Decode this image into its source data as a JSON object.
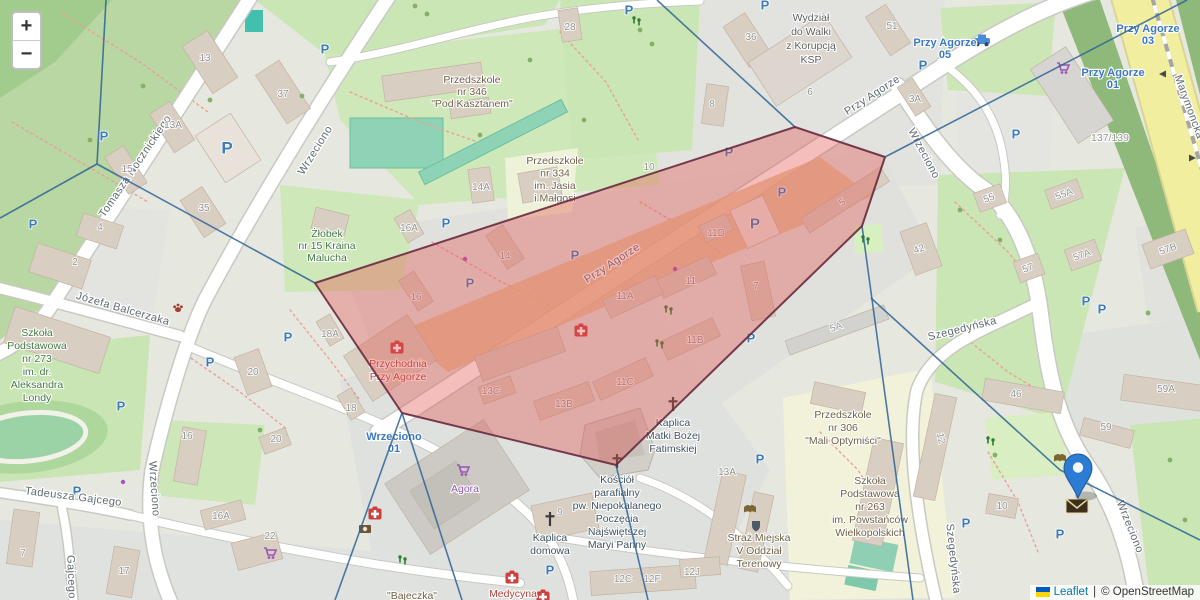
{
  "controls": {
    "zoom_in": "+",
    "zoom_out": "−"
  },
  "attribution": {
    "leaflet": "Leaflet",
    "separator": "|",
    "osm": "© OpenStreetMap"
  },
  "colors": {
    "polygon_fill": "#e35550",
    "polygon_border": "#68293f",
    "voronoi_line": "#2e6395",
    "marker_blue": "#2c7cd3",
    "transit_blue": "#3a78c2",
    "parking_blue": "#3d7ab8",
    "ukraine_flag_top": "#005BBB",
    "ukraine_flag_bottom": "#FFD500"
  },
  "overlay": {
    "polygon_points": [
      [
        315,
        283
      ],
      [
        795,
        127
      ],
      [
        885,
        157
      ],
      [
        862,
        226
      ],
      [
        616,
        465
      ],
      [
        402,
        413
      ]
    ],
    "lines": [
      [
        [
          106,
          0
        ],
        [
          97,
          164
        ]
      ],
      [
        [
          97,
          164
        ],
        [
          0,
          218
        ]
      ],
      [
        [
          97,
          164
        ],
        [
          315,
          283
        ]
      ],
      [
        [
          657,
          0
        ],
        [
          795,
          127
        ]
      ],
      [
        [
          885,
          157
        ],
        [
          1187,
          0
        ]
      ],
      [
        [
          862,
          226
        ],
        [
          883,
          380
        ],
        [
          913,
          600
        ]
      ],
      [
        [
          871,
          298
        ],
        [
          1060,
          470
        ],
        [
          1200,
          540
        ]
      ],
      [
        [
          616,
          465
        ],
        [
          648,
          600
        ]
      ],
      [
        [
          402,
          413
        ],
        [
          335,
          600
        ]
      ],
      [
        [
          402,
          413
        ],
        [
          462,
          600
        ]
      ]
    ],
    "marker": {
      "x": 1078,
      "y": 498
    }
  },
  "streets": [
    {
      "name": "Tomasza Nocznickiego",
      "x": 138,
      "y": 168,
      "r": -56
    },
    {
      "name": "Wrzeciono",
      "x": 318,
      "y": 152,
      "r": -58
    },
    {
      "name": "Przy Agorze",
      "x": 874,
      "y": 98,
      "r": -33
    },
    {
      "name": "Przy Agorze",
      "x": 614,
      "y": 266,
      "r": -33
    },
    {
      "name": "Wrzeciono",
      "x": 921,
      "y": 155,
      "r": 62
    },
    {
      "name": "Józefa Balcerzaka",
      "x": 122,
      "y": 312,
      "r": 16
    },
    {
      "name": "Wrzeciono",
      "x": 151,
      "y": 489,
      "r": 86
    },
    {
      "name": "Tadeusza Gajcego",
      "x": 73,
      "y": 500,
      "r": 7
    },
    {
      "name": "Gajcego",
      "x": 68,
      "y": 577,
      "r": 88
    },
    {
      "name": "Szegedyńska",
      "x": 963,
      "y": 332,
      "r": -14
    },
    {
      "name": "Szegedyńska",
      "x": 950,
      "y": 559,
      "r": 84
    },
    {
      "name": "Wrzeciono",
      "x": 1127,
      "y": 528,
      "r": 68
    },
    {
      "name": "Marymoncka",
      "x": 1186,
      "y": 108,
      "r": 70
    }
  ],
  "transit_stops": [
    {
      "lines": [
        "Przy Agorze",
        "05"
      ],
      "x": 945,
      "y": 46
    },
    {
      "lines": [
        "Przy Agorze",
        "03"
      ],
      "x": 1148,
      "y": 32
    },
    {
      "lines": [
        "Przy Agorze",
        "01"
      ],
      "x": 1113,
      "y": 76
    },
    {
      "lines": [
        "Wrzeciono",
        "01"
      ],
      "x": 394,
      "y": 440
    }
  ],
  "pois": [
    {
      "lines": [
        "Żłobek",
        "nr 15 Kraina",
        "Malucha"
      ],
      "x": 327,
      "y": 237,
      "lh": 12,
      "color": "green"
    },
    {
      "lines": [
        "Szkoła",
        "Podstawowa",
        "nr 273",
        "im. dr.",
        "Aleksandra",
        "Londy"
      ],
      "x": 37,
      "y": 336,
      "lh": 13,
      "color": "green"
    },
    {
      "lines": [
        "Przedszkole",
        "nr 346",
        "\"Pod Kasztanem\""
      ],
      "x": 472,
      "y": 83,
      "lh": 12,
      "color": "brown"
    },
    {
      "lines": [
        "Przedszkole",
        "nr 334",
        "im. Jasia",
        "i Małgosi"
      ],
      "x": 555,
      "y": 164,
      "lh": 12.5,
      "color": "brown"
    },
    {
      "lines": [
        "Wydział",
        "do Walki",
        "z Korupcją",
        "KSP"
      ],
      "x": 811,
      "y": 21,
      "lh": 14,
      "color": "gray"
    },
    {
      "lines": [
        "Przychodnia",
        "Przy Agorze"
      ],
      "x": 398,
      "y": 367,
      "lh": 13,
      "color": "red"
    },
    {
      "lines": [
        "Kościół",
        "parafialny",
        "pw. Niepokalanego",
        "Poczęcia",
        "Najświętszej",
        "Maryi Panny"
      ],
      "x": 617,
      "y": 483,
      "lh": 13,
      "color": "dark"
    },
    {
      "lines": [
        "Kaplica",
        "domowa"
      ],
      "x": 550,
      "y": 541,
      "lh": 13,
      "color": "dark"
    },
    {
      "lines": [
        "Kaplica",
        "Matki Bożej",
        "Fatimskiej"
      ],
      "x": 673,
      "y": 426,
      "lh": 13,
      "color": "dark"
    },
    {
      "lines": [
        "Straż Miejska",
        "V Oddział",
        "Terenowy"
      ],
      "x": 759,
      "y": 541,
      "lh": 13,
      "color": "brown"
    },
    {
      "lines": [
        "Przedszkole",
        "nr 306",
        "\"Mali Optymiści\""
      ],
      "x": 843,
      "y": 418,
      "lh": 13,
      "color": "brown"
    },
    {
      "lines": [
        "Szkoła",
        "Podstawowa",
        "nr 263",
        "im. Powstańców",
        "Wielkopolskich"
      ],
      "x": 870,
      "y": 484,
      "lh": 13,
      "color": "brown"
    },
    {
      "lines": [
        "Agora"
      ],
      "x": 465,
      "y": 492,
      "lh": 13,
      "color": "purple"
    },
    {
      "lines": [
        "Medycyna"
      ],
      "x": 513,
      "y": 597,
      "lh": 13,
      "color": "red"
    },
    {
      "lines": [
        "\"Bajeczka\""
      ],
      "x": 412,
      "y": 599,
      "lh": 13,
      "color": "brown"
    },
    {
      "lines": [
        "137/139"
      ],
      "x": 1110,
      "y": 141,
      "lh": 13,
      "color": "ltgray"
    }
  ],
  "building_numbers": [
    {
      "t": "13",
      "x": 205,
      "y": 61
    },
    {
      "t": "37",
      "x": 283,
      "y": 97
    },
    {
      "t": "13A",
      "x": 173,
      "y": 128
    },
    {
      "t": "15",
      "x": 127,
      "y": 172
    },
    {
      "t": "35",
      "x": 204,
      "y": 211
    },
    {
      "t": "28",
      "x": 570,
      "y": 30
    },
    {
      "t": "4",
      "x": 100,
      "y": 230
    },
    {
      "t": "2",
      "x": 75,
      "y": 265
    },
    {
      "t": "20",
      "x": 253,
      "y": 375
    },
    {
      "t": "18A",
      "x": 330,
      "y": 337
    },
    {
      "t": "18",
      "x": 351,
      "y": 411
    },
    {
      "t": "16A",
      "x": 409,
      "y": 231
    },
    {
      "t": "16",
      "x": 416,
      "y": 300
    },
    {
      "t": "14A",
      "x": 481,
      "y": 190
    },
    {
      "t": "14",
      "x": 505,
      "y": 259
    },
    {
      "t": "10",
      "x": 649,
      "y": 170
    },
    {
      "t": "8",
      "x": 712,
      "y": 107
    },
    {
      "t": "36",
      "x": 751,
      "y": 40
    },
    {
      "t": "6",
      "x": 810,
      "y": 95
    },
    {
      "t": "51",
      "x": 892,
      "y": 29
    },
    {
      "t": "3A",
      "x": 915,
      "y": 102
    },
    {
      "t": "13A",
      "x": 727,
      "y": 475
    },
    {
      "t": "13C",
      "x": 491,
      "y": 394
    },
    {
      "t": "13B",
      "x": 564,
      "y": 407
    },
    {
      "t": "11C",
      "x": 625,
      "y": 385
    },
    {
      "t": "11B",
      "x": 695,
      "y": 343
    },
    {
      "t": "11A",
      "x": 625,
      "y": 299
    },
    {
      "t": "11",
      "x": 691,
      "y": 284
    },
    {
      "t": "11D",
      "x": 716,
      "y": 236
    },
    {
      "t": "7",
      "x": 756,
      "y": 289
    },
    {
      "t": "5",
      "x": 844,
      "y": 205,
      "r": -33
    },
    {
      "t": "5A",
      "x": 837,
      "y": 330,
      "r": -20
    },
    {
      "t": "42",
      "x": 920,
      "y": 252,
      "r": -20
    },
    {
      "t": "55",
      "x": 990,
      "y": 201,
      "r": -20
    },
    {
      "t": "55A",
      "x": 1065,
      "y": 197,
      "r": -20
    },
    {
      "t": "57",
      "x": 1029,
      "y": 271,
      "r": -20
    },
    {
      "t": "57A",
      "x": 1083,
      "y": 258,
      "r": -20
    },
    {
      "t": "57B",
      "x": 1169,
      "y": 252,
      "r": -20
    },
    {
      "t": "59A",
      "x": 1166,
      "y": 392
    },
    {
      "t": "46",
      "x": 1016,
      "y": 397
    },
    {
      "t": "59",
      "x": 1106,
      "y": 430
    },
    {
      "t": "12",
      "x": 938,
      "y": 439,
      "r": 78
    },
    {
      "t": "10",
      "x": 1002,
      "y": 509
    },
    {
      "t": "16",
      "x": 187,
      "y": 439
    },
    {
      "t": "20",
      "x": 276,
      "y": 442
    },
    {
      "t": "7",
      "x": 23,
      "y": 556
    },
    {
      "t": "17",
      "x": 124,
      "y": 574
    },
    {
      "t": "16A",
      "x": 221,
      "y": 519
    },
    {
      "t": "22",
      "x": 270,
      "y": 539
    },
    {
      "t": "12C",
      "x": 623,
      "y": 582
    },
    {
      "t": "12F",
      "x": 652,
      "y": 582
    },
    {
      "t": "12J",
      "x": 692,
      "y": 575
    },
    {
      "t": "9",
      "x": 560,
      "y": 515
    }
  ],
  "icons": {
    "parking_glyph": "P",
    "parking": [
      [
        104,
        136
      ],
      [
        227,
        149,
        17
      ],
      [
        325,
        49
      ],
      [
        33,
        224
      ],
      [
        629,
        10
      ],
      [
        446,
        223
      ],
      [
        575,
        255
      ],
      [
        470,
        283
      ],
      [
        729,
        152
      ],
      [
        782,
        192
      ],
      [
        755,
        224,
        15
      ],
      [
        751,
        338
      ],
      [
        210,
        362
      ],
      [
        288,
        337
      ],
      [
        121,
        406
      ],
      [
        966,
        523
      ],
      [
        760,
        459
      ],
      [
        550,
        570
      ],
      [
        1060,
        534
      ],
      [
        1086,
        301
      ],
      [
        1102,
        309
      ],
      [
        1016,
        134
      ],
      [
        923,
        65
      ],
      [
        765,
        5
      ],
      [
        77,
        491
      ]
    ],
    "carts": [
      [
        463,
        470
      ],
      [
        1063,
        68
      ],
      [
        270,
        553
      ]
    ],
    "medical": [
      [
        397,
        348
      ],
      [
        581,
        331
      ],
      [
        375,
        514
      ],
      [
        512,
        578
      ],
      [
        543,
        597
      ]
    ],
    "crosses": [
      [
        617,
        461
      ],
      [
        673,
        404
      ],
      [
        550,
        519
      ]
    ],
    "books": [
      [
        750,
        510
      ],
      [
        1060,
        459
      ]
    ],
    "playgrounds": [
      [
        669,
        310
      ],
      [
        660,
        344
      ],
      [
        403,
        560
      ],
      [
        866,
        240
      ],
      [
        991,
        441
      ],
      [
        637,
        21
      ]
    ],
    "purple_dots": [
      [
        465,
        259
      ],
      [
        675,
        269
      ],
      [
        123,
        482
      ]
    ],
    "car": [
      982,
      41
    ],
    "paw": [
      178,
      308
    ],
    "camera": [
      365,
      529
    ],
    "envelope": [
      1077,
      506
    ],
    "shield": [
      756,
      526
    ]
  }
}
